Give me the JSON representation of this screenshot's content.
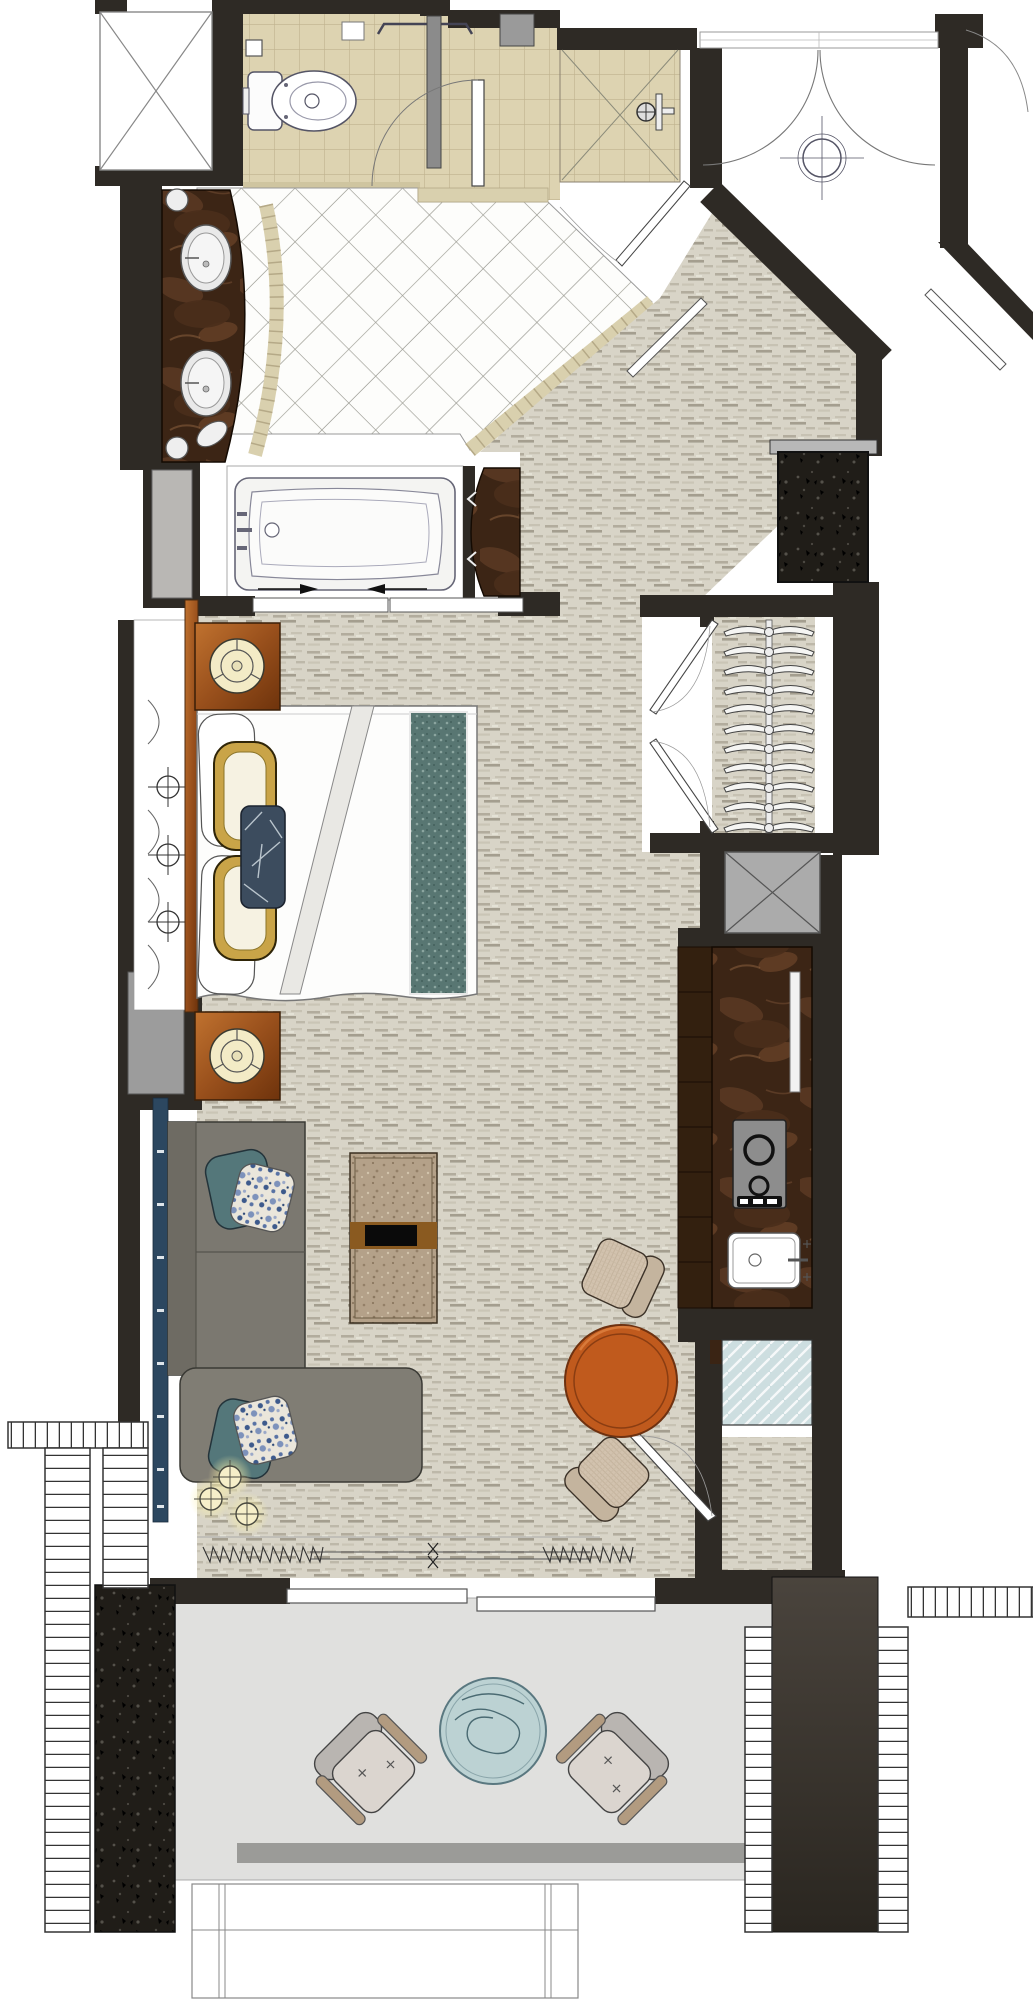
{
  "title": "Hotel guestroom floor plan with bathroom, bedroom, living area, kitchenette and balcony",
  "palette": {
    "wall": "#2e2a25",
    "carpet": "#d8d4c7",
    "bathroom_tile": "#ddd3b1",
    "diamond_tile": "#fdfdfb",
    "marble_counter": "#3c2515",
    "wood_furniture": "#a35620",
    "lamp_shade": "#f3ebc6",
    "gold_pillow": "#c9a448",
    "navy_bolster": "#3c4c5e",
    "teal_runner": "#587672",
    "sofa_gray": "#7b7870",
    "accent_orange_table": "#c05a1d",
    "balcony_floor": "#e0e0de",
    "balcony_table_blue": "#bcd2d3",
    "drapery_navy": "#2c4760",
    "glass_blue": "#cddee0",
    "shaft_gray": "#ababab"
  },
  "rooms": [
    {
      "name": "water-closet",
      "floor": "beige square tile",
      "items": [
        "toilet",
        "toilet-paper-holder",
        "towel-bar",
        "switch-plate",
        "privacy-door"
      ]
    },
    {
      "name": "shower",
      "floor": "beige square tile",
      "items": [
        "shower-head",
        "glass-enclosure",
        "angled-glass-door"
      ]
    },
    {
      "name": "bathroom",
      "floor": "white diamond tile",
      "items": [
        "double-sink-vanity",
        "marble-counter",
        "bathtub",
        "sliding-tub-doors",
        "marble-partition"
      ]
    },
    {
      "name": "entry-vestibule",
      "floor": "white",
      "items": [
        "double-entry-doors",
        "ceiling-fixture-symbol"
      ]
    },
    {
      "name": "closet",
      "floor": "carpet",
      "items": [
        "hanging-rod",
        "11-hangers",
        "double-doors"
      ]
    },
    {
      "name": "bedroom",
      "floor": "carpet",
      "items": [
        "king-bed",
        "headboard",
        "nightstand-with-lamp-x2",
        "gold-pillows",
        "navy-bolster",
        "teal-foot-runner",
        "window-drapes"
      ]
    },
    {
      "name": "kitchenette",
      "floor": "carpet",
      "items": [
        "marble-bar-counter",
        "two-burner-cooktop",
        "bar-sink",
        "glass-panel",
        "service-shaft"
      ]
    },
    {
      "name": "living-area",
      "floor": "carpet",
      "items": [
        "sectional-sofa-with-chaise",
        "accent-pillows",
        "coffee-table",
        "round-orange-table",
        "cube-chair-x2",
        "floor-lamp-cluster",
        "navy-drapery",
        "sliding-balcony-door"
      ]
    },
    {
      "name": "balcony",
      "floor": "concrete gray",
      "items": [
        "lounge-chair-x2",
        "round-blue-table",
        "white-railing",
        "concrete-column-x2"
      ]
    }
  ]
}
